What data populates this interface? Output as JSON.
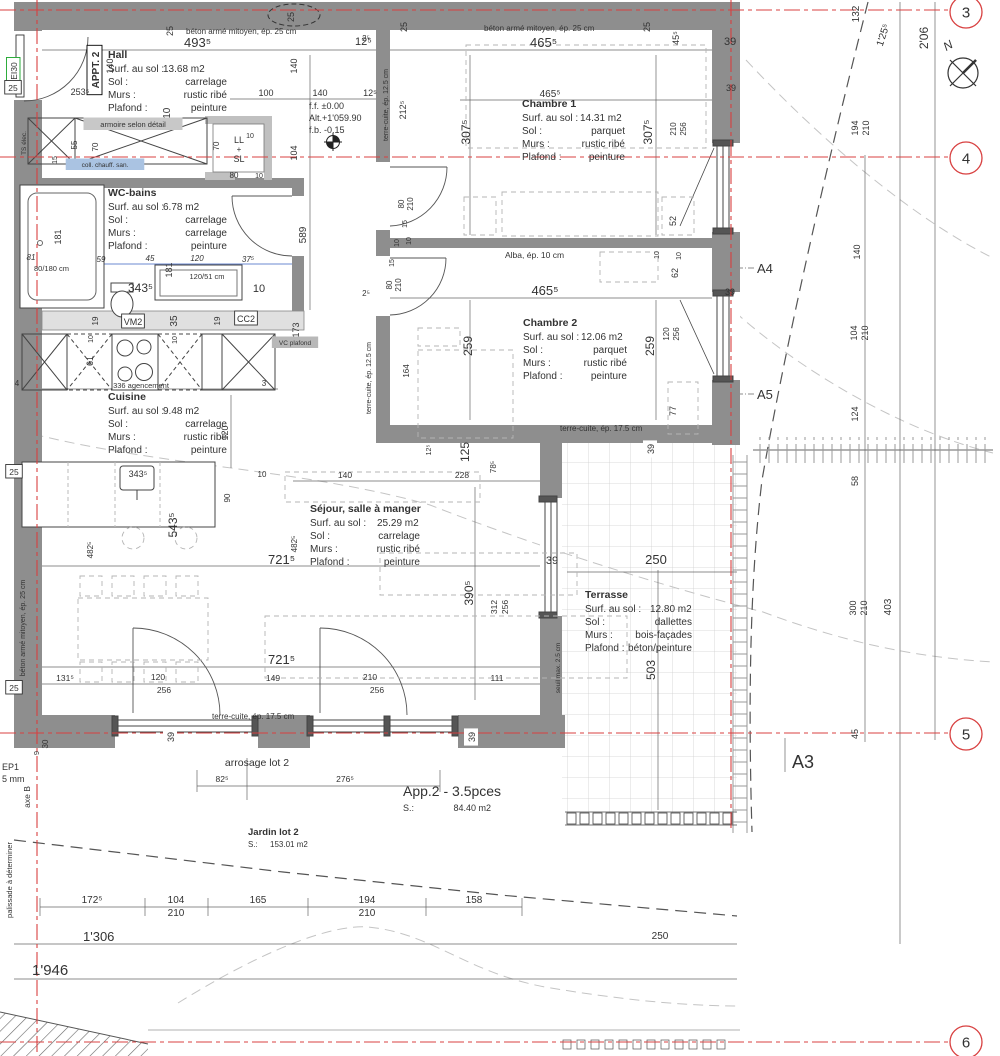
{
  "colors": {
    "grid_red": "#d84040",
    "wall_gray": "#8e8e8e",
    "wall_light": "#c0c0c0",
    "dim_blue": "#3a62c0",
    "fire_green": "#18a428"
  },
  "rooms": [
    {
      "id": "hall",
      "name": "Hall",
      "x": 108,
      "y": 58,
      "w": 119,
      "vx": 55,
      "rows": [
        [
          "Surf. au sol :",
          "13.68 m2"
        ],
        [
          "Sol :",
          "carrelage"
        ],
        [
          "Murs :",
          "rustic ribé"
        ],
        [
          "Plafond :",
          "peinture"
        ]
      ]
    },
    {
      "id": "wc-bains",
      "name": "WC-bains",
      "x": 108,
      "y": 196,
      "w": 119,
      "vx": 55,
      "rows": [
        [
          "Surf. au sol :",
          "6.78 m2"
        ],
        [
          "Sol :",
          "carrelage"
        ],
        [
          "Murs :",
          "carrelage"
        ],
        [
          "Plafond :",
          "peinture"
        ]
      ]
    },
    {
      "id": "cuisine",
      "name": "Cuisine",
      "x": 108,
      "y": 400,
      "w": 119,
      "vx": 55,
      "rows": [
        [
          "Surf. au sol :",
          "9.48 m2"
        ],
        [
          "Sol :",
          "carrelage"
        ],
        [
          "Murs :",
          "rustic ribé"
        ],
        [
          "Plafond :",
          "peinture"
        ]
      ]
    },
    {
      "id": "chambre1",
      "name": "Chambre 1",
      "x": 522,
      "y": 107,
      "w": 103,
      "vx": 58,
      "rows": [
        [
          "Surf. au sol :",
          "14.31 m2"
        ],
        [
          "Sol :",
          "parquet"
        ],
        [
          "Murs :",
          "rustic ribé"
        ],
        [
          "Plafond :",
          "peinture"
        ]
      ]
    },
    {
      "id": "chambre2",
      "name": "Chambre 2",
      "x": 523,
      "y": 326,
      "w": 104,
      "vx": 58,
      "rows": [
        [
          "Surf. au sol :",
          "12.06 m2"
        ],
        [
          "Sol :",
          "parquet"
        ],
        [
          "Murs :",
          "rustic ribé"
        ],
        [
          "Plafond :",
          "peinture"
        ]
      ]
    },
    {
      "id": "sejour",
      "name": "Séjour, salle à manger",
      "x": 310,
      "y": 512,
      "w": 110,
      "vx": 67,
      "rows": [
        [
          "Surf. au sol :",
          "25.29 m2"
        ],
        [
          "Sol :",
          "carrelage"
        ],
        [
          "Murs :",
          "rustic ribé"
        ],
        [
          "Plafond :",
          "peinture"
        ]
      ]
    },
    {
      "id": "terrasse",
      "name": "Terrasse",
      "x": 585,
      "y": 598,
      "w": 107,
      "vx": 65,
      "rows": [
        [
          "Surf. au sol :",
          "12.80 m2"
        ],
        [
          "Sol :",
          "dallettes"
        ],
        [
          "Murs :",
          "bois-façades"
        ],
        [
          "Plafond :",
          "béton/peinture"
        ]
      ]
    }
  ],
  "grid_bubbles": [
    {
      "n": "3",
      "x": 966,
      "y": 12
    },
    {
      "n": "4",
      "x": 966,
      "y": 158
    },
    {
      "n": "5",
      "x": 966,
      "y": 734
    },
    {
      "n": "6",
      "x": 966,
      "y": 1042
    }
  ],
  "labels": [
    {
      "t": "25",
      "x": 173,
      "y": 31,
      "r": -90,
      "s": 9
    },
    {
      "t": "25",
      "x": 294,
      "y": 17,
      "r": -90,
      "s": 9
    },
    {
      "t": "béton armé mitoyen, ép. 25 cm",
      "x": 186,
      "y": 34,
      "a": "s",
      "s": 8
    },
    {
      "t": "493⁵",
      "x": 184,
      "y": 47,
      "a": "s",
      "s": 13
    },
    {
      "t": "12⁵",
      "x": 355,
      "y": 45,
      "a": "s",
      "s": 11
    },
    {
      "t": "25",
      "x": 407,
      "y": 27,
      "r": -90,
      "s": 9
    },
    {
      "t": "25",
      "x": 650,
      "y": 27,
      "r": -90,
      "s": 9
    },
    {
      "t": "béton armé mitoyen, ép. 25 cm",
      "x": 484,
      "y": 31,
      "a": "s",
      "s": 8
    },
    {
      "t": "465⁵",
      "x": 530,
      "y": 47,
      "a": "s",
      "s": 13
    },
    {
      "t": "45⁵",
      "x": 679,
      "y": 38,
      "r": -90,
      "s": 9
    },
    {
      "t": "39",
      "x": 724,
      "y": 45,
      "a": "s",
      "s": 11
    },
    {
      "t": "132",
      "x": 859,
      "y": 14,
      "r": -90,
      "s": 10
    },
    {
      "t": "1'25⁵",
      "x": 886,
      "y": 36,
      "r": -72,
      "s": 10
    },
    {
      "t": "2'06",
      "x": 928,
      "y": 38,
      "r": -90,
      "s": 12
    },
    {
      "t": "N",
      "x": 950,
      "y": 49,
      "r": -30,
      "s": 12,
      "i": 1,
      "n": "north-label"
    },
    {
      "t": "APPT. 2",
      "x": 99,
      "y": 70,
      "r": -90,
      "s": 10,
      "b": 1,
      "bg": "#fff",
      "bs": "#000",
      "n": "apartment-tag"
    },
    {
      "t": "EI30",
      "x": 17,
      "y": 71,
      "r": -90,
      "s": 8.5,
      "c": "#18a428",
      "bg": "#fff",
      "bs": "#18a428",
      "n": "fire-rating-tag"
    },
    {
      "t": "140",
      "x": 113,
      "y": 66,
      "r": -90,
      "s": 9
    },
    {
      "t": "253⁵",
      "x": 80,
      "y": 95,
      "s": 9
    },
    {
      "t": "25",
      "x": 13,
      "y": 91,
      "s": 8.5,
      "bg": "#fff",
      "bs": "#333"
    },
    {
      "t": "210",
      "x": 170,
      "y": 116,
      "r": -90,
      "s": 10
    },
    {
      "t": "140",
      "x": 297,
      "y": 66,
      "r": -90,
      "s": 9
    },
    {
      "t": "100",
      "x": 266,
      "y": 96,
      "s": 9
    },
    {
      "t": "140",
      "x": 320,
      "y": 96,
      "s": 9
    },
    {
      "t": "12⁵",
      "x": 370,
      "y": 96,
      "s": 9
    },
    {
      "t": "104",
      "x": 297,
      "y": 153,
      "r": -90,
      "s": 9
    },
    {
      "t": "2⁵",
      "x": 366,
      "y": 41,
      "s": 8
    },
    {
      "t": "f.f. ±0.00",
      "x": 309,
      "y": 109,
      "a": "s",
      "s": 9,
      "n": "level-ff"
    },
    {
      "t": "Alt.+1'059.90",
      "x": 309,
      "y": 121,
      "a": "s",
      "s": 9,
      "n": "level-alt"
    },
    {
      "t": "f.b. -0.15",
      "x": 309,
      "y": 133,
      "a": "s",
      "s": 9,
      "n": "level-fb"
    },
    {
      "t": "armoire selon détail",
      "x": 133,
      "y": 127,
      "s": 7.5,
      "bg": "#c8c8c8"
    },
    {
      "t": "TS élec.",
      "x": 26,
      "y": 143,
      "r": -90,
      "s": 6.5
    },
    {
      "t": "55",
      "x": 77,
      "y": 145,
      "r": -90,
      "s": 8
    },
    {
      "t": "70",
      "x": 98,
      "y": 147,
      "r": -90,
      "s": 8
    },
    {
      "t": "15",
      "x": 57,
      "y": 160,
      "r": -90,
      "s": 7
    },
    {
      "t": "coll. chauff. san.",
      "x": 105,
      "y": 167,
      "s": 6.5,
      "bg": "#aac3e2",
      "c": "#1a3a8c"
    },
    {
      "t": "LL",
      "x": 239,
      "y": 143,
      "s": 9
    },
    {
      "t": "+",
      "x": 239,
      "y": 152,
      "s": 8
    },
    {
      "t": "SL",
      "x": 239,
      "y": 162,
      "s": 9
    },
    {
      "t": "70",
      "x": 219,
      "y": 146,
      "r": -90,
      "s": 8
    },
    {
      "t": "10",
      "x": 250,
      "y": 138,
      "s": 7
    },
    {
      "t": "80",
      "x": 234,
      "y": 178,
      "s": 8
    },
    {
      "t": "10",
      "x": 259,
      "y": 178,
      "s": 7
    },
    {
      "t": "terre-cuite, ép. 12.5 cm",
      "x": 388,
      "y": 105,
      "r": -90,
      "s": 7
    },
    {
      "t": "212⁵",
      "x": 406,
      "y": 110,
      "r": -90,
      "s": 9
    },
    {
      "t": "589",
      "x": 306,
      "y": 235,
      "r": -90,
      "s": 10
    },
    {
      "t": "181",
      "x": 61,
      "y": 237,
      "r": -90,
      "s": 9
    },
    {
      "t": "81",
      "x": 31,
      "y": 260,
      "s": 8,
      "c": "#3a62c0",
      "i": 1
    },
    {
      "t": "59",
      "x": 101,
      "y": 262,
      "s": 8,
      "c": "#3a62c0",
      "i": 1
    },
    {
      "t": "45",
      "x": 150,
      "y": 261,
      "s": 8,
      "c": "#3a62c0",
      "i": 1
    },
    {
      "t": "120",
      "x": 197,
      "y": 261,
      "s": 8,
      "c": "#3a62c0",
      "i": 1
    },
    {
      "t": "37⁵",
      "x": 248,
      "y": 262,
      "s": 8,
      "c": "#3a62c0",
      "i": 1
    },
    {
      "t": "80/180 cm",
      "x": 34,
      "y": 271,
      "a": "s",
      "s": 7.5
    },
    {
      "t": "181",
      "x": 172,
      "y": 270,
      "r": -90,
      "s": 9
    },
    {
      "t": "343⁵",
      "x": 128,
      "y": 292,
      "a": "s",
      "s": 12
    },
    {
      "t": "120/51 cm",
      "x": 207,
      "y": 279,
      "s": 7.5
    },
    {
      "t": "10",
      "x": 259,
      "y": 292,
      "s": 11
    },
    {
      "t": "173",
      "x": 299,
      "y": 330,
      "r": -90,
      "s": 9
    },
    {
      "t": "VM2",
      "x": 133,
      "y": 325,
      "s": 9,
      "bg": "#fff",
      "bs": "#333"
    },
    {
      "t": "CC2",
      "x": 246,
      "y": 322,
      "s": 9,
      "bg": "#fff",
      "bs": "#333"
    },
    {
      "t": "35",
      "x": 177,
      "y": 321,
      "r": -90,
      "s": 10
    },
    {
      "t": "19",
      "x": 98,
      "y": 321,
      "r": -90,
      "s": 8
    },
    {
      "t": "19",
      "x": 220,
      "y": 321,
      "r": -90,
      "s": 8
    },
    {
      "t": "10",
      "x": 93,
      "y": 339,
      "r": -90,
      "s": 7
    },
    {
      "t": "10",
      "x": 177,
      "y": 340,
      "r": -90,
      "s": 7
    },
    {
      "t": "VC plafond",
      "x": 295,
      "y": 345,
      "s": 6.5,
      "bg": "#b8b8b8",
      "c": "#1a3a8c"
    },
    {
      "t": "61",
      "x": 93,
      "y": 361,
      "r": -90,
      "s": 9
    },
    {
      "t": "336 agencement",
      "x": 141,
      "y": 388,
      "s": 7.5
    },
    {
      "t": "4",
      "x": 17,
      "y": 386,
      "s": 8
    },
    {
      "t": "3",
      "x": 264,
      "y": 386,
      "s": 8
    },
    {
      "t": "120",
      "x": 228,
      "y": 433,
      "r": -90,
      "s": 9
    },
    {
      "t": "343⁵",
      "x": 138,
      "y": 477,
      "s": 9
    },
    {
      "t": "10",
      "x": 262,
      "y": 477,
      "s": 8
    },
    {
      "t": "90",
      "x": 230,
      "y": 498,
      "r": -90,
      "s": 8
    },
    {
      "t": "543⁵",
      "x": 177,
      "y": 525,
      "r": -90,
      "s": 12
    },
    {
      "t": "482⁵",
      "x": 93,
      "y": 550,
      "r": -90,
      "s": 8
    },
    {
      "t": "25",
      "x": 14,
      "y": 475,
      "s": 8.5,
      "bg": "#fff",
      "bs": "#333"
    },
    {
      "t": "25",
      "x": 14,
      "y": 691,
      "s": 8.5,
      "bg": "#fff",
      "bs": "#333"
    },
    {
      "t": "béton armé mitoyen, ép. 25 cm",
      "x": 25,
      "y": 628,
      "r": -90,
      "s": 7
    },
    {
      "t": "482⁵",
      "x": 297,
      "y": 544,
      "r": -90,
      "s": 8
    },
    {
      "t": "721⁵",
      "x": 268,
      "y": 564,
      "a": "s",
      "s": 13
    },
    {
      "t": "721⁵",
      "x": 268,
      "y": 664,
      "a": "s",
      "s": 13
    },
    {
      "t": "140",
      "x": 345,
      "y": 478,
      "s": 8.5
    },
    {
      "t": "228",
      "x": 462,
      "y": 478,
      "s": 8.5
    },
    {
      "t": "12⁵",
      "x": 431,
      "y": 450,
      "r": -90,
      "s": 7
    },
    {
      "t": "125",
      "x": 469,
      "y": 452,
      "r": -90,
      "s": 12
    },
    {
      "t": "78⁵",
      "x": 496,
      "y": 467,
      "r": -90,
      "s": 8
    },
    {
      "t": "390⁵",
      "x": 473,
      "y": 593,
      "r": -90,
      "s": 12
    },
    {
      "t": "312",
      "x": 497,
      "y": 607,
      "r": -90,
      "s": 8.5
    },
    {
      "t": "256",
      "x": 508,
      "y": 607,
      "r": -90,
      "s": 8.5
    },
    {
      "t": "131⁵",
      "x": 65,
      "y": 681,
      "s": 8.5
    },
    {
      "t": "120",
      "x": 158,
      "y": 680,
      "s": 8.5
    },
    {
      "t": "256",
      "x": 164,
      "y": 693,
      "s": 8.5
    },
    {
      "t": "149",
      "x": 273,
      "y": 681,
      "s": 8.5
    },
    {
      "t": "210",
      "x": 370,
      "y": 680,
      "s": 8.5
    },
    {
      "t": "256",
      "x": 377,
      "y": 693,
      "s": 8.5
    },
    {
      "t": "111",
      "x": 497,
      "y": 681,
      "s": 8.5
    },
    {
      "t": "terre-cuite, ép. 17.5 cm",
      "x": 212,
      "y": 719,
      "a": "s",
      "s": 8
    },
    {
      "t": "39",
      "x": 174,
      "y": 737,
      "r": -90,
      "s": 9,
      "bg": "#fff"
    },
    {
      "t": "39",
      "x": 475,
      "y": 737,
      "r": -90,
      "s": 9,
      "bg": "#fff"
    },
    {
      "t": "465⁵",
      "x": 550,
      "y": 97,
      "s": 10
    },
    {
      "t": "307⁵",
      "x": 470,
      "y": 132,
      "r": -90,
      "s": 12
    },
    {
      "t": "307⁵",
      "x": 652,
      "y": 132,
      "r": -90,
      "s": 12
    },
    {
      "t": "80",
      "x": 404,
      "y": 204,
      "r": -90,
      "s": 8
    },
    {
      "t": "210",
      "x": 413,
      "y": 204,
      "r": -90,
      "s": 8
    },
    {
      "t": "15",
      "x": 407,
      "y": 224,
      "r": -90,
      "s": 7
    },
    {
      "t": "10",
      "x": 411,
      "y": 241,
      "r": -90,
      "s": 7
    },
    {
      "t": "52",
      "x": 676,
      "y": 221,
      "r": -90,
      "s": 9
    },
    {
      "t": "210",
      "x": 676,
      "y": 129,
      "r": -90,
      "s": 8
    },
    {
      "t": "256",
      "x": 686,
      "y": 129,
      "r": -90,
      "s": 8
    },
    {
      "t": "39",
      "x": 731,
      "y": 91,
      "s": 9
    },
    {
      "t": "Alba, ép. 10 cm",
      "x": 505,
      "y": 258,
      "a": "s",
      "s": 8.5
    },
    {
      "t": "2⁵",
      "x": 366,
      "y": 296,
      "s": 8
    },
    {
      "t": "15",
      "x": 394,
      "y": 263,
      "r": -90,
      "s": 7
    },
    {
      "t": "10",
      "x": 399,
      "y": 243,
      "r": -90,
      "s": 7
    },
    {
      "t": "80",
      "x": 392,
      "y": 285,
      "r": -90,
      "s": 8
    },
    {
      "t": "210",
      "x": 401,
      "y": 285,
      "r": -90,
      "s": 8
    },
    {
      "t": "465⁵",
      "x": 545,
      "y": 295,
      "s": 13
    },
    {
      "t": "259",
      "x": 472,
      "y": 346,
      "r": -90,
      "s": 12
    },
    {
      "t": "259",
      "x": 654,
      "y": 346,
      "r": -90,
      "s": 12
    },
    {
      "t": "164",
      "x": 409,
      "y": 371,
      "r": -90,
      "s": 8
    },
    {
      "t": "terre-cuite, ép. 12.5 cm",
      "x": 371,
      "y": 378,
      "r": -90,
      "s": 7
    },
    {
      "t": "62",
      "x": 678,
      "y": 273,
      "r": -90,
      "s": 9
    },
    {
      "t": "10",
      "x": 659,
      "y": 255,
      "r": -90,
      "s": 7
    },
    {
      "t": "10",
      "x": 681,
      "y": 256,
      "r": -90,
      "s": 7
    },
    {
      "t": "120",
      "x": 669,
      "y": 334,
      "r": -90,
      "s": 8
    },
    {
      "t": "256",
      "x": 679,
      "y": 334,
      "r": -90,
      "s": 8
    },
    {
      "t": "39",
      "x": 730,
      "y": 295,
      "s": 9
    },
    {
      "t": "77",
      "x": 676,
      "y": 411,
      "r": -90,
      "s": 9
    },
    {
      "t": "terre-cuite, ép. 17.5 cm",
      "x": 560,
      "y": 431,
      "a": "s",
      "s": 8
    },
    {
      "t": "39",
      "x": 654,
      "y": 449,
      "r": -90,
      "s": 9,
      "bg": "#fff"
    },
    {
      "t": "39",
      "x": 552,
      "y": 564,
      "s": 11
    },
    {
      "t": "250",
      "x": 656,
      "y": 564,
      "s": 13
    },
    {
      "t": "503",
      "x": 655,
      "y": 670,
      "r": -90,
      "s": 12
    },
    {
      "t": "seuil max. 2.5 cm",
      "x": 560,
      "y": 668,
      "r": -90,
      "s": 6.5
    },
    {
      "t": "A4",
      "x": 757,
      "y": 273,
      "a": "s",
      "s": 13,
      "n": "section-marker-a4"
    },
    {
      "t": "A5",
      "x": 757,
      "y": 399,
      "a": "s",
      "s": 13,
      "n": "section-marker-a5"
    },
    {
      "t": "A3",
      "x": 792,
      "y": 768,
      "a": "s",
      "s": 18,
      "n": "section-marker-a3"
    },
    {
      "t": "194",
      "x": 858,
      "y": 128,
      "r": -90,
      "s": 9
    },
    {
      "t": "210",
      "x": 869,
      "y": 128,
      "r": -90,
      "s": 9
    },
    {
      "t": "140",
      "x": 860,
      "y": 252,
      "r": -90,
      "s": 9
    },
    {
      "t": "104",
      "x": 857,
      "y": 333,
      "r": -90,
      "s": 9
    },
    {
      "t": "210",
      "x": 868,
      "y": 333,
      "r": -90,
      "s": 9
    },
    {
      "t": "124",
      "x": 858,
      "y": 414,
      "r": -90,
      "s": 9
    },
    {
      "t": "58",
      "x": 858,
      "y": 481,
      "r": -90,
      "s": 9
    },
    {
      "t": "300",
      "x": 856,
      "y": 608,
      "r": -90,
      "s": 9
    },
    {
      "t": "210",
      "x": 867,
      "y": 608,
      "r": -90,
      "s": 9
    },
    {
      "t": "403",
      "x": 891,
      "y": 607,
      "r": -90,
      "s": 10
    },
    {
      "t": "45",
      "x": 858,
      "y": 734,
      "r": -90,
      "s": 9
    },
    {
      "t": "arrosage lot 2",
      "x": 257,
      "y": 766,
      "s": 10.5,
      "n": "arrosage-label"
    },
    {
      "t": "82⁵",
      "x": 222,
      "y": 782,
      "s": 8.5
    },
    {
      "t": "276⁵",
      "x": 345,
      "y": 782,
      "s": 8.5
    },
    {
      "t": "App.2 - 3.5pces",
      "x": 403,
      "y": 796,
      "a": "s",
      "s": 14,
      "c": "#4a4a4a",
      "n": "apartment-area-label"
    },
    {
      "t": "S.:",
      "x": 403,
      "y": 811,
      "a": "s",
      "s": 9
    },
    {
      "t": "84.40 m2",
      "x": 491,
      "y": 811,
      "a": "e",
      "s": 9
    },
    {
      "t": "Jardin lot 2",
      "x": 248,
      "y": 835,
      "a": "s",
      "s": 9.5,
      "b": 1,
      "n": "jardin-label"
    },
    {
      "t": "S.:",
      "x": 248,
      "y": 847,
      "a": "s",
      "s": 8
    },
    {
      "t": "153.01 m2",
      "x": 270,
      "y": 847,
      "a": "s",
      "s": 8
    },
    {
      "t": "172⁵",
      "x": 92,
      "y": 903,
      "s": 10
    },
    {
      "t": "104",
      "x": 176,
      "y": 903,
      "s": 10
    },
    {
      "t": "210",
      "x": 176,
      "y": 916,
      "s": 10
    },
    {
      "t": "165",
      "x": 258,
      "y": 903,
      "s": 10
    },
    {
      "t": "194",
      "x": 367,
      "y": 903,
      "s": 10
    },
    {
      "t": "210",
      "x": 367,
      "y": 916,
      "s": 10
    },
    {
      "t": "158",
      "x": 474,
      "y": 903,
      "s": 10
    },
    {
      "t": "250",
      "x": 660,
      "y": 939,
      "s": 10
    },
    {
      "t": "1'306",
      "x": 83,
      "y": 941,
      "a": "s",
      "s": 13
    },
    {
      "t": "1'946",
      "x": 32,
      "y": 975,
      "a": "s",
      "s": 15
    },
    {
      "t": "EP1",
      "x": 2,
      "y": 770,
      "a": "s",
      "s": 9,
      "n": "ep1-label"
    },
    {
      "t": "5 mm",
      "x": 2,
      "y": 782,
      "a": "s",
      "s": 9
    },
    {
      "t": "axe B",
      "x": 30,
      "y": 797,
      "r": -90,
      "s": 8.5
    },
    {
      "t": "palissade à déterminer",
      "x": 12,
      "y": 880,
      "r": -90,
      "s": 7.5
    },
    {
      "t": "30",
      "x": 48,
      "y": 744,
      "r": -90,
      "s": 8,
      "c": "#d84040"
    },
    {
      "t": "9",
      "x": 39,
      "y": 753,
      "r": -90,
      "s": 7.5
    }
  ]
}
